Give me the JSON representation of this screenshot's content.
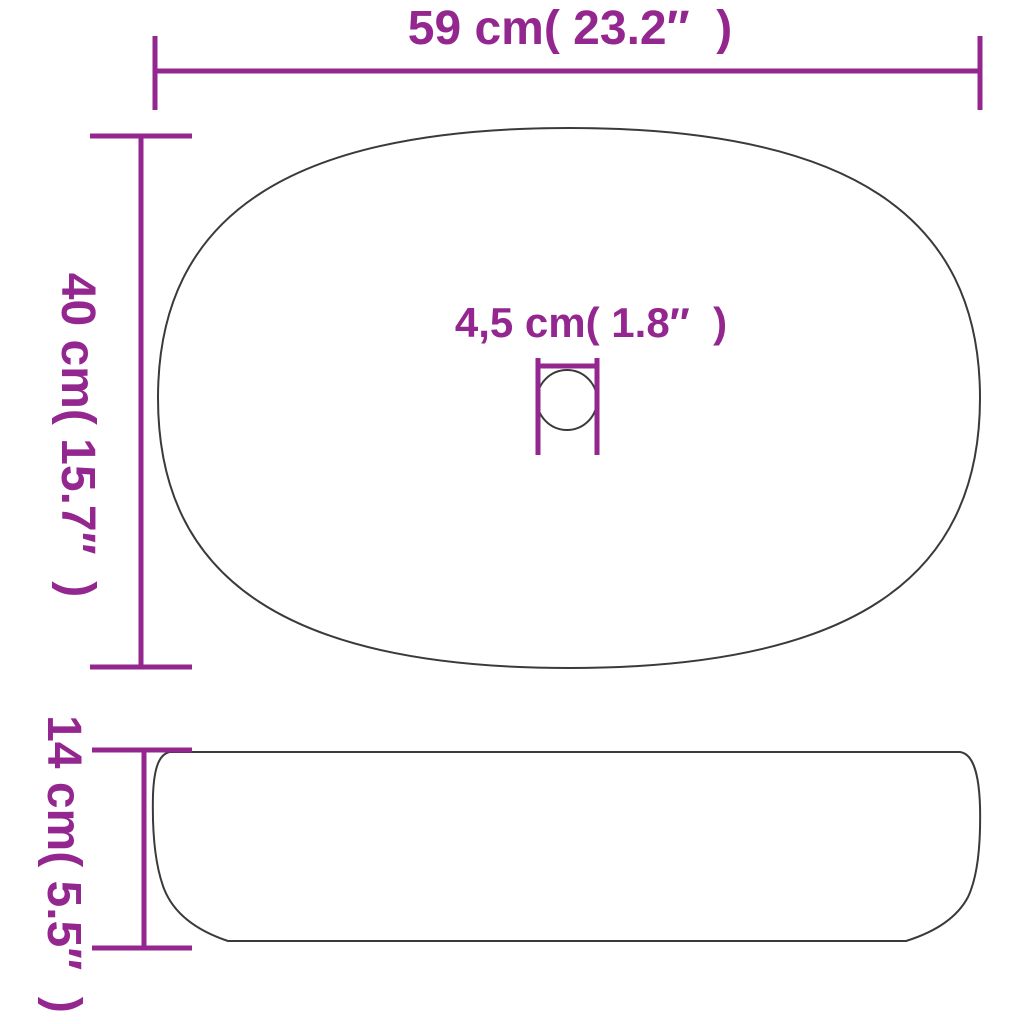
{
  "colors": {
    "dimension": "#93278F",
    "outline": "#3a3a3a"
  },
  "views": {
    "top": {
      "name": "basin top view",
      "width_label": "59 cm( 23.2″  )",
      "depth_label": "40 cm( 15.7″  )",
      "drain_label": "4,5 cm( 1.8″  )"
    },
    "side": {
      "name": "basin side view",
      "height_label": "14 cm( 5.5″  )"
    }
  }
}
